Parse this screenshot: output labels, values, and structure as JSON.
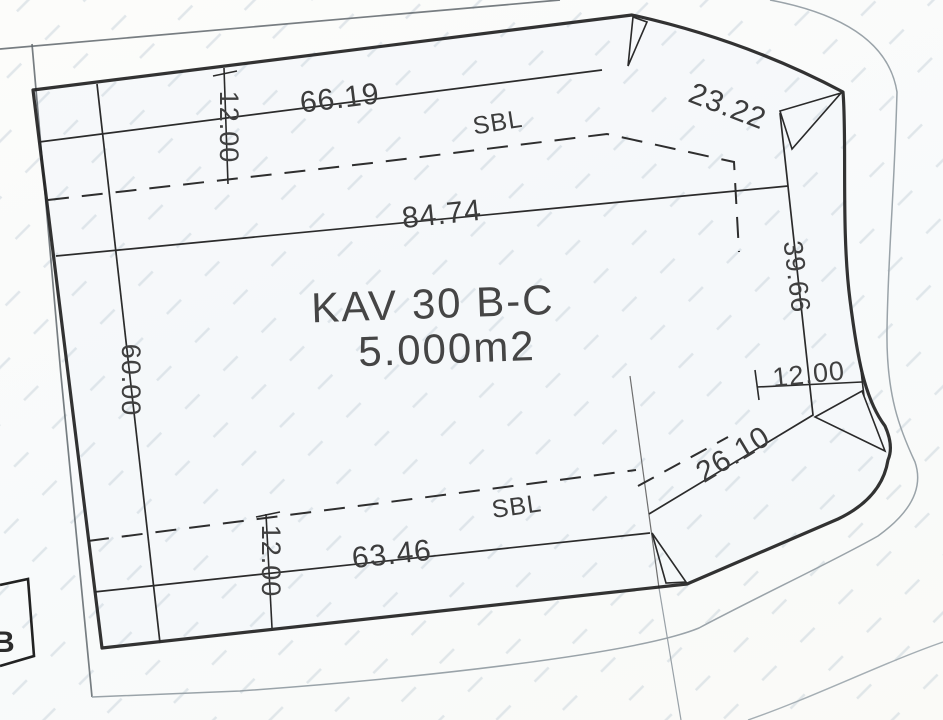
{
  "drawing": {
    "parcel": {
      "label": "KAV 30 B-C",
      "area": "5.000m2"
    },
    "setback": {
      "top_label": "SBL",
      "bottom_label": "SBL"
    },
    "dimensions": {
      "top_edge": "66.19",
      "top_right_edge": "23.22",
      "setback_offset_top": "12.00",
      "width_at_setback": "84.74",
      "left_edge": "60.00",
      "right_edge": "39.66",
      "setback_offset_right": "12.00",
      "bottom_right_edge": "26.10",
      "bottom_edge": "63.46",
      "setback_offset_bottom": "12.00"
    },
    "neighbor": {
      "label": "B"
    },
    "colors": {
      "boundary_line": "#212121",
      "thin_line": "#2b2b2b",
      "faint_line": "#9aa3a9",
      "hatch": "#c6d1d9",
      "text": "#3a3a3a",
      "background": "#fbfbf8"
    }
  }
}
